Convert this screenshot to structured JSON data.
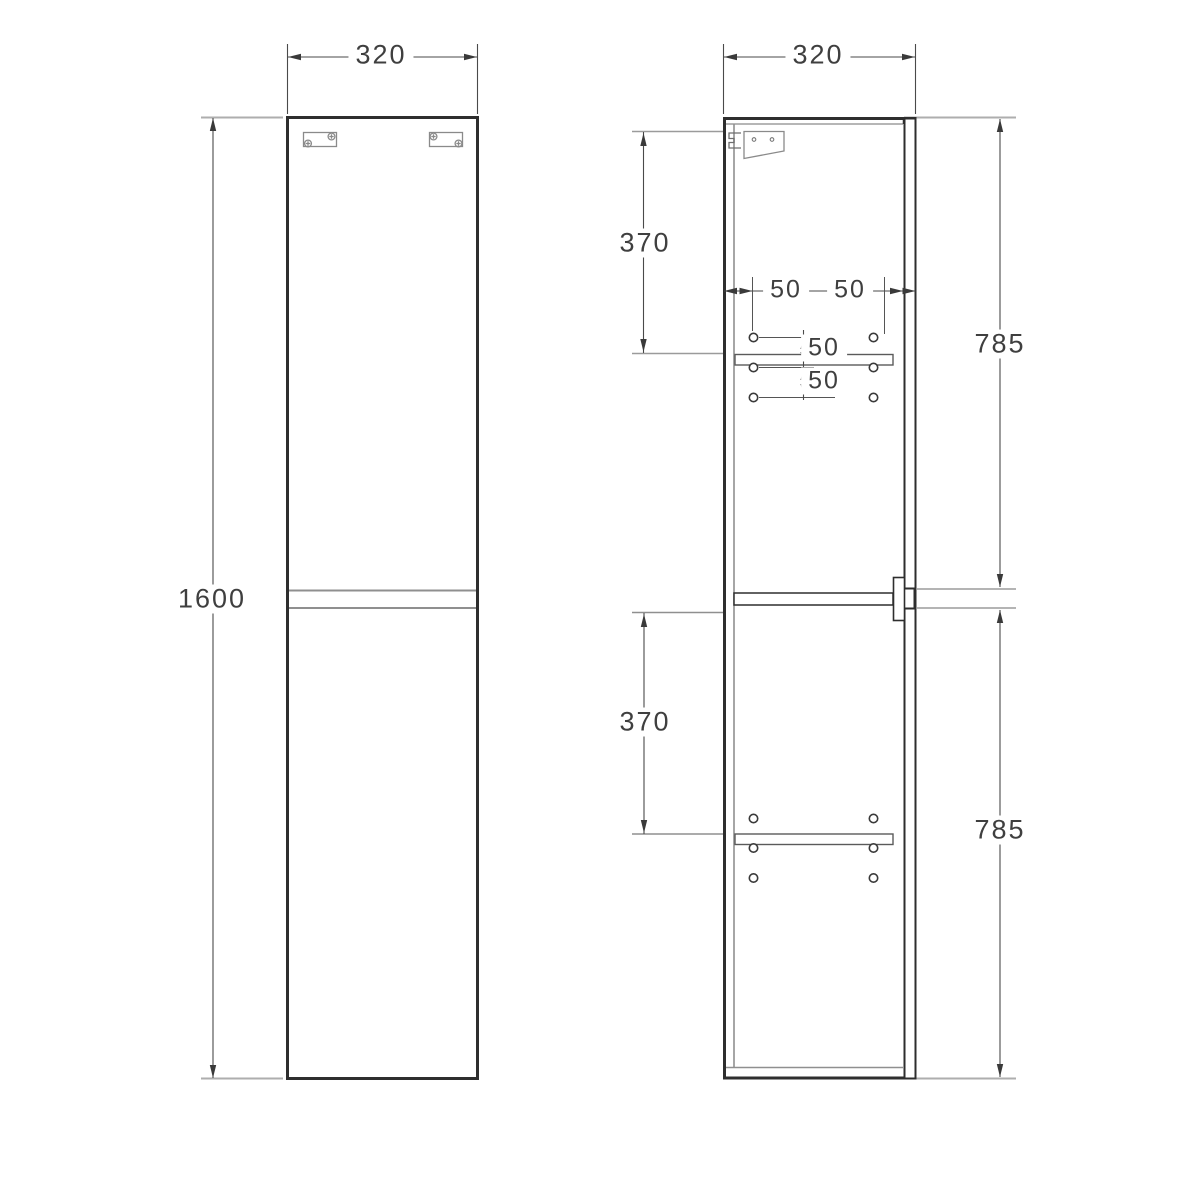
{
  "drawing_title": "Tall cabinet technical drawing",
  "units": "mm",
  "colors": {
    "outline": "#2e2e2e",
    "dimension_line": "#4a4a4a",
    "extension_line": "#a8a8a8",
    "dimension_text": "#3f3f3f",
    "background": "#ffffff"
  },
  "views": {
    "front": {
      "width": "320",
      "height": "1600"
    },
    "side": {
      "width": "320",
      "upper_shelf_offset": "370",
      "lower_shelf_offset": "370",
      "upper_door_height": "785",
      "lower_door_height": "785",
      "hole_inset_left": "50",
      "hole_inset_right": "50",
      "hole_pitch_upper": "50",
      "hole_pitch_lower": "50"
    }
  }
}
